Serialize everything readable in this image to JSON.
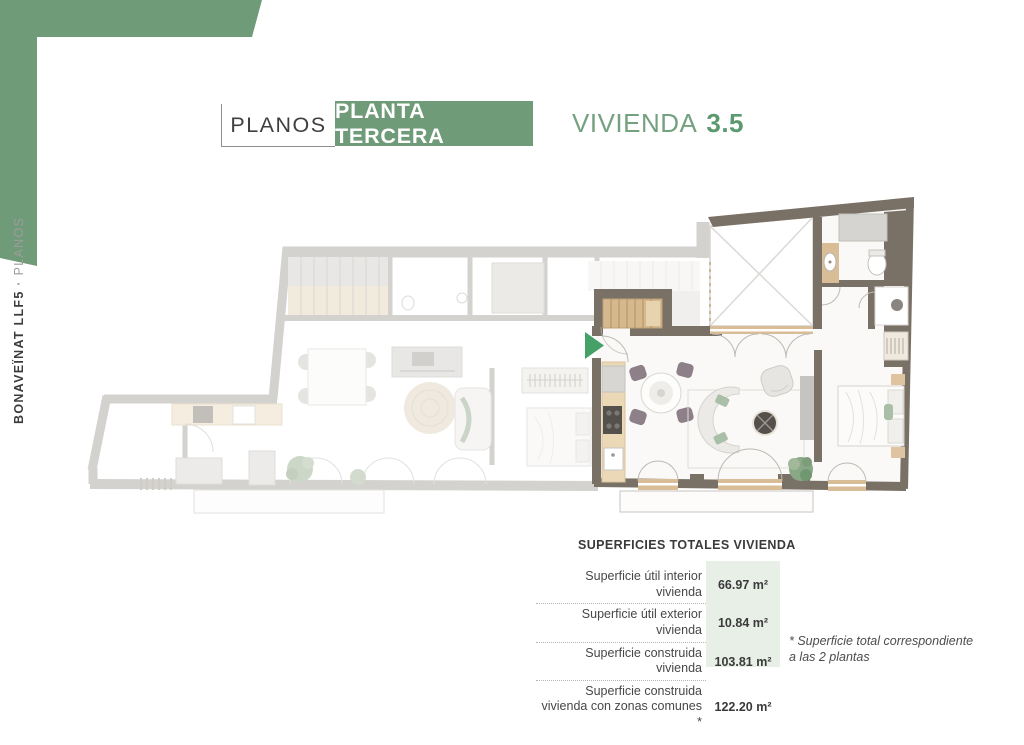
{
  "header": {
    "section_label": "PLANOS",
    "floor_label": "PLANTA TERCERA",
    "unit_prefix": "VIVIENDA",
    "unit_number": "3.5"
  },
  "sidebar": {
    "project": "BONAVEÏNAT LLF5",
    "separator": "·",
    "section": "PLANOS"
  },
  "summary_table": {
    "title": "SUPERFICIES TOTALES VIVIENDA",
    "rows": [
      {
        "label": "Superficie útil interior vivienda",
        "value": "66.97 m²"
      },
      {
        "label": "Superficie útil exterior vivienda",
        "value": "10.84 m²"
      },
      {
        "label": "Superficie construida vivienda",
        "value": "103.81 m²"
      },
      {
        "label": "Superficie construida vivienda con zonas comunes *",
        "value": "122.20 m²"
      }
    ],
    "footnote": "* Superficie total correspondiente a las 2 plantas"
  },
  "floor_plan": {
    "highlighted_unit": "Vivienda 3.5",
    "entry_marker": "green-arrow"
  },
  "colors": {
    "accent_green": "#6f9b78",
    "accent_green_dark": "#5b9a6e",
    "entry_arrow_green": "#46a169",
    "wall_dark": "#7a7166",
    "value_cell_bg": "#e8efe7",
    "wood": "#d5b88e"
  }
}
